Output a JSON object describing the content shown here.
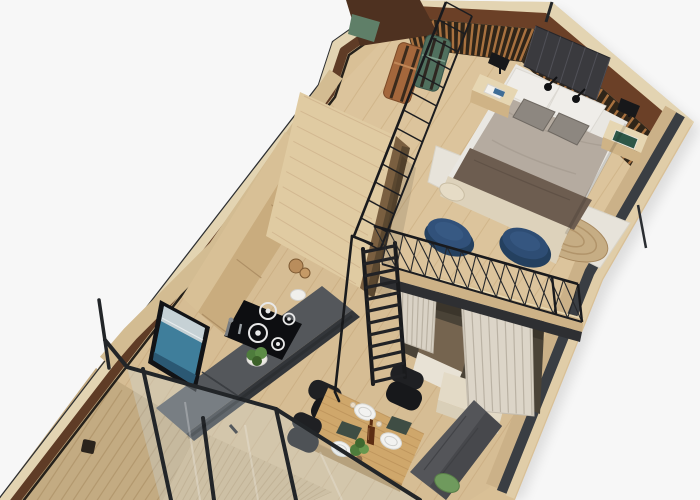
{
  "scene": {
    "description": "3D isometric cutaway rendering of a tiny house interior floor plan",
    "view": "top-down axonometric, building rotated diagonally on white background",
    "areas": [
      {
        "name": "loft-bedroom",
        "contents": "double bed, two nightstands with black lamps, slatted wood accent wall, dark quilted headboard, two vintage suitcases, wire railing, two round blue poufs, white rug, round jute rug"
      },
      {
        "name": "kitchenette",
        "contents": "tall wood wardrobe, upper cabinets, grey countertop, black induction cooktop with four rings, sink with drainboard, faucet, TV with seascape picture, herb plant, white bowl"
      },
      {
        "name": "sleeping-nook",
        "contents": "curtained alcove under loft with brown mattress and white bedding"
      },
      {
        "name": "dining-area",
        "contents": "wood table with three white plates, bottle, potted plant, two placemats, three black chairs, grey bench with green pillow"
      },
      {
        "name": "stair",
        "contents": "black steel ship-ladder to loft with handrail"
      },
      {
        "name": "entry",
        "contents": "glazed wall with black-framed glass door, wood deck boards, vertical siding"
      }
    ],
    "object_counts": {
      "bed_pillows": 2,
      "accent_cushions": 2,
      "nightstands": 2,
      "table_lamps": 2,
      "suitcases": 2,
      "blue_poufs": 2,
      "cooktop_rings": 4,
      "dining_plates": 3,
      "dining_chairs": 3,
      "glass_door_mullions": 3,
      "ladder_rungs": 12
    }
  },
  "palette": {
    "bg": "#f7f7f7",
    "wood_floor": "#d9c096",
    "wood_plank": "#c3a478",
    "wood_light": "#e3d4b2",
    "wood_mid": "#cfb386",
    "wood_deep": "#b2946a",
    "wall_brown": "#5f3c26",
    "mahogany": "#6b4027",
    "slat_wood": "#a8713f",
    "slat_dark": "#2f2519",
    "steel": "#3a3e43",
    "frame_black": "#222528",
    "counter": "#54575b",
    "counter_front": "#33363a",
    "cooktop": "#0d0e11",
    "white_soft": "#efede9",
    "duvet": "#b5aba0",
    "blanket": "#6d5d50",
    "cream": "#ddd2bb",
    "rug": "#e7e3da",
    "jute": "#c6ad84",
    "pouf_blue": "#31517a",
    "pouf_blue_light": "#3a5d88",
    "curtain": "#d9d2c5",
    "curtain_shadow": "#b5ad9e",
    "nook_dark": "#4a4337",
    "nook_mattress": "#75644f",
    "sofa_grey": "#545559",
    "sofa_grey_dark": "#47484c",
    "pillow_green": "#6f9a5d",
    "table_wood": "#cfa76b",
    "plate_white": "#f2f2f0",
    "bottle_brown": "#5c2d13",
    "plant_green": "#4e7c3c",
    "tv_screen_teal": "#3f7e9b",
    "tv_sky": "#cdd6d8",
    "glass_tint": "rgba(205,218,224,0.30)",
    "suitcase_green": "#50705e",
    "suitcase_copper": "#a4673c",
    "strap_brown": "#3a2a1c",
    "bench_green": "#5f7f68",
    "siding": "#c3ab82",
    "deck": "#cdb58b",
    "headboard": "#3a3a3e"
  }
}
